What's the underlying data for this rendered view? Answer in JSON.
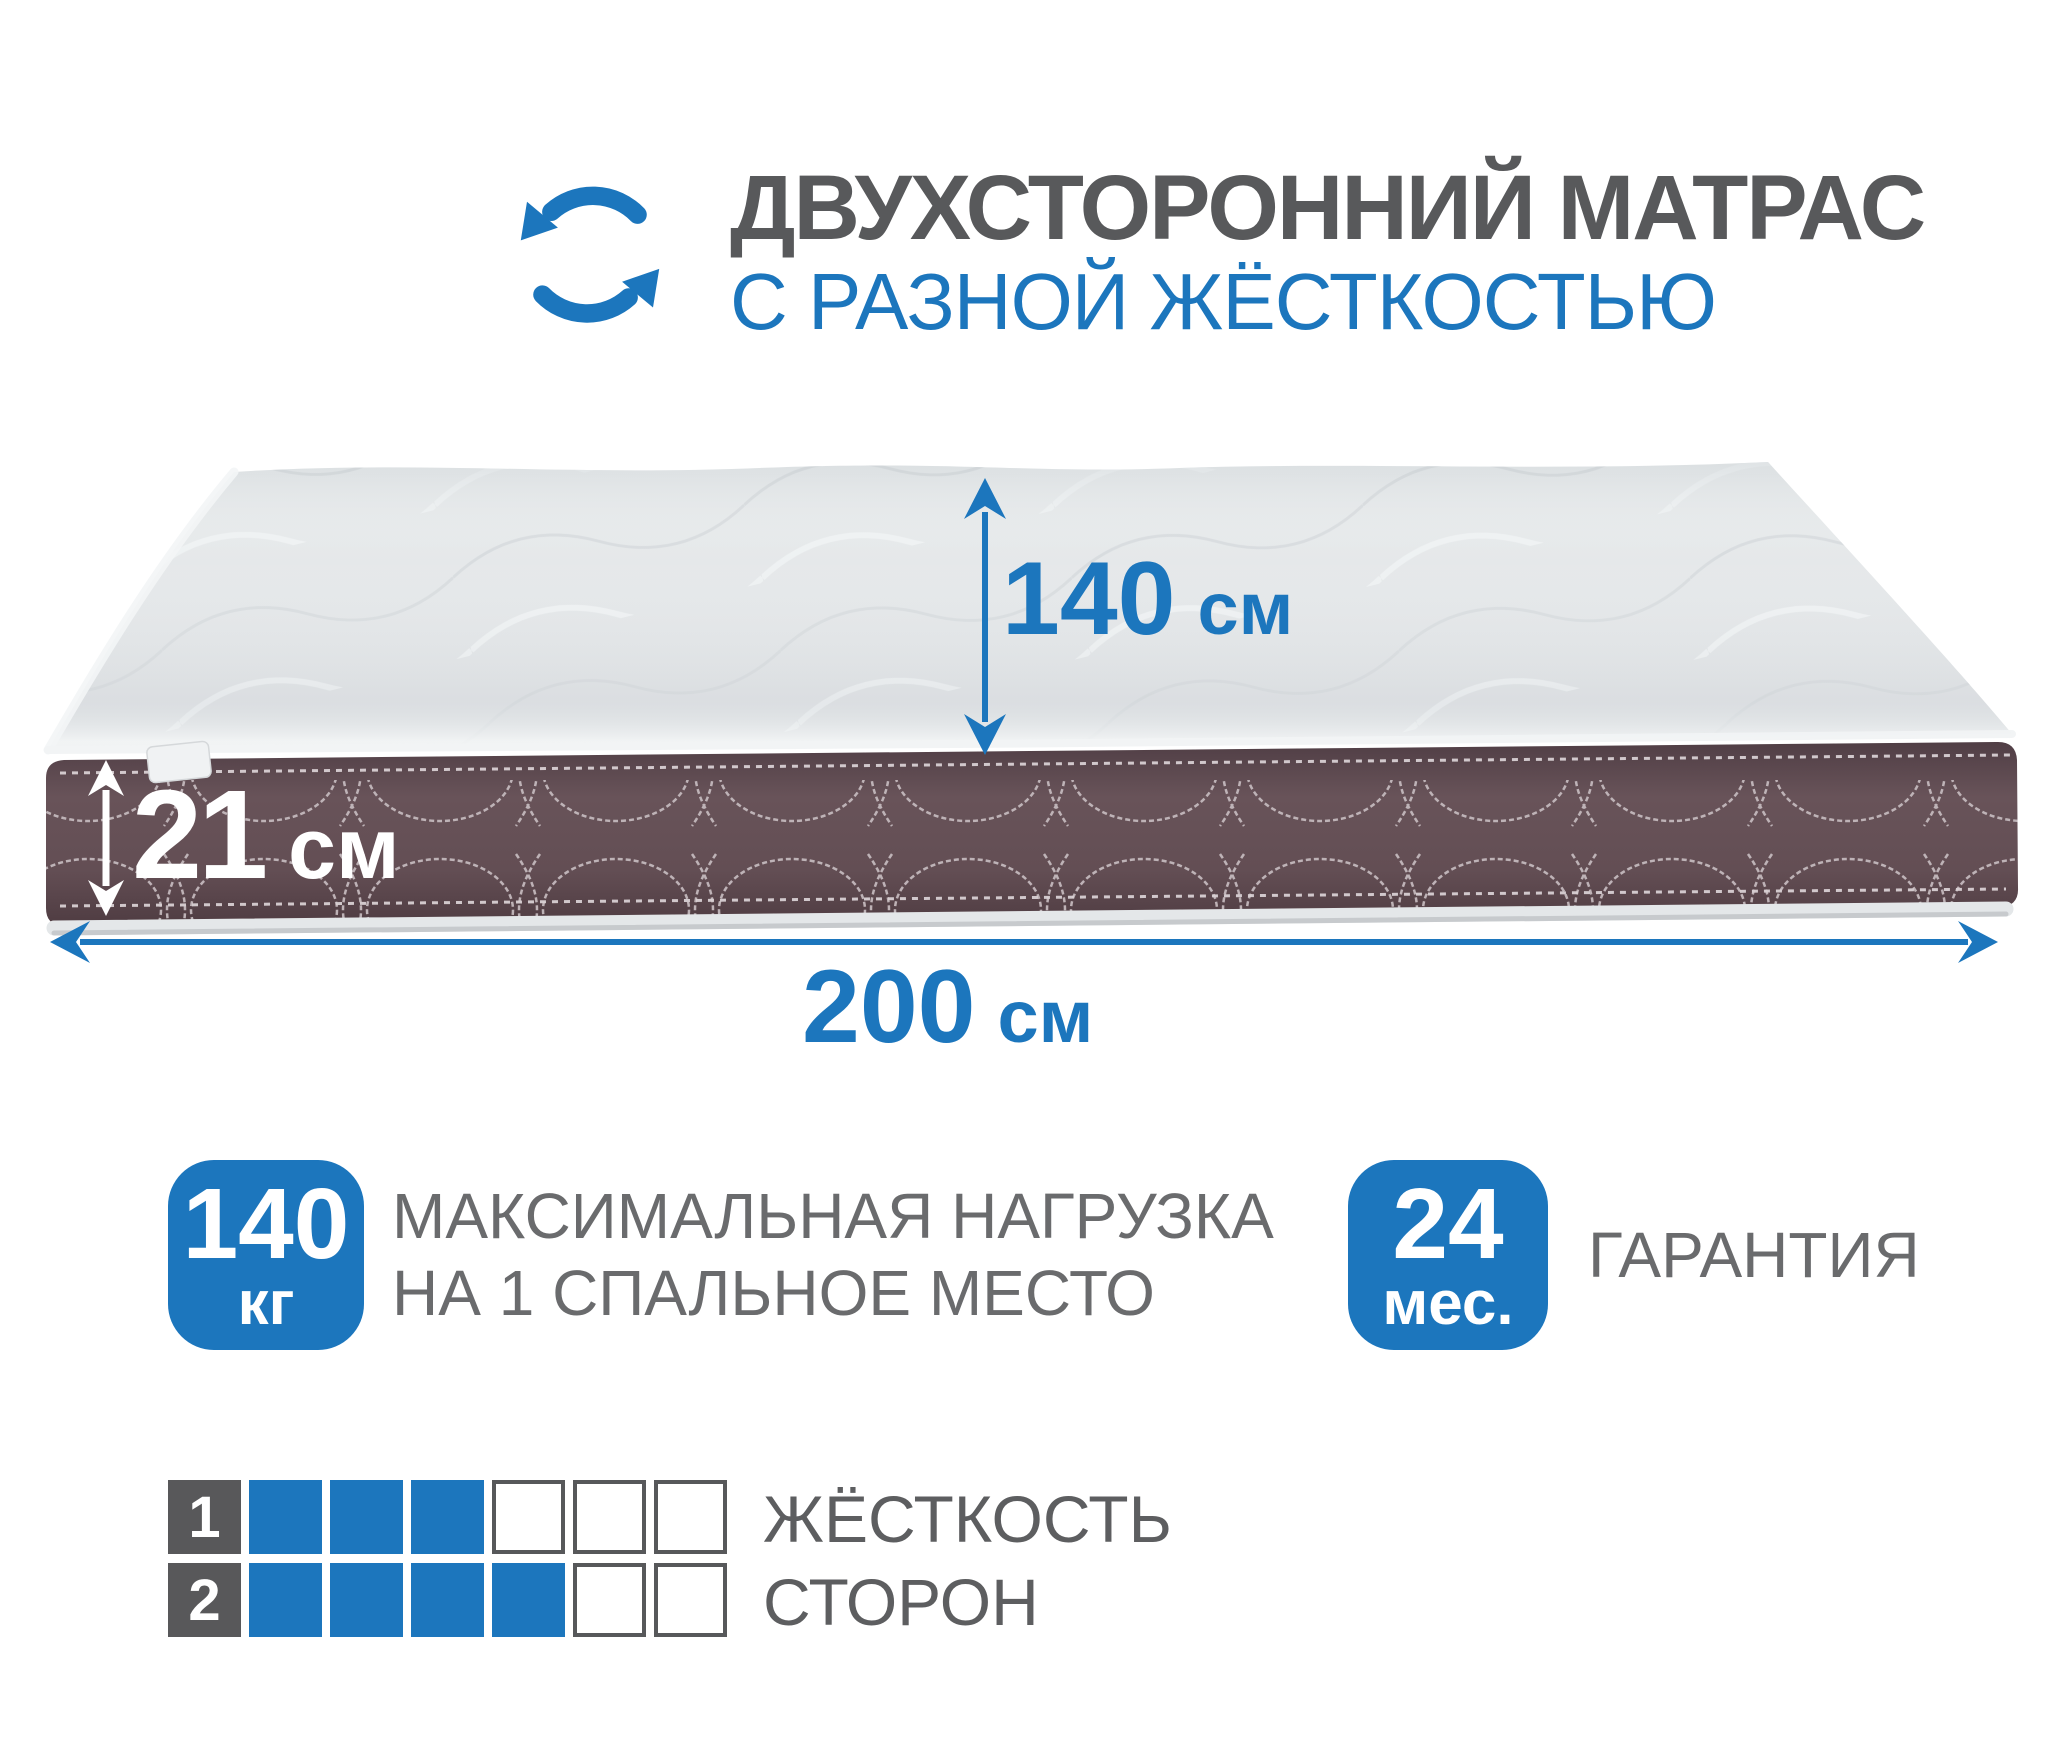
{
  "header": {
    "title": "ДВУХСТОРОННИЙ МАТРАС",
    "subtitle": "С РАЗНОЙ ЖЁСТКОСТЬЮ"
  },
  "dimensions": {
    "width": {
      "value": "140",
      "unit": "см"
    },
    "height": {
      "value": "21",
      "unit": "см"
    },
    "length": {
      "value": "200",
      "unit": "см"
    }
  },
  "badges": {
    "max_load": {
      "value": "140",
      "unit": "кг",
      "line1": "МАКСИМАЛЬНАЯ НАГРУЗКА",
      "line2": "НА 1 СПАЛЬНОЕ МЕСТО"
    },
    "warranty": {
      "value": "24",
      "unit": "мес.",
      "label": "ГАРАНТИЯ"
    }
  },
  "firmness": {
    "line1": "ЖЁСТКОСТЬ",
    "line2": "СТОРОН",
    "scale_max": 6,
    "sides": [
      {
        "side": "1",
        "value": 3
      },
      {
        "side": "2",
        "value": 4
      }
    ]
  },
  "colors": {
    "accent_blue": "#1c76bd",
    "title_gray": "#58595b",
    "text_gray": "#6a6b6d",
    "band_brown": "#634f55"
  },
  "icons": {
    "rotate": "circular-rotate-arrows"
  }
}
